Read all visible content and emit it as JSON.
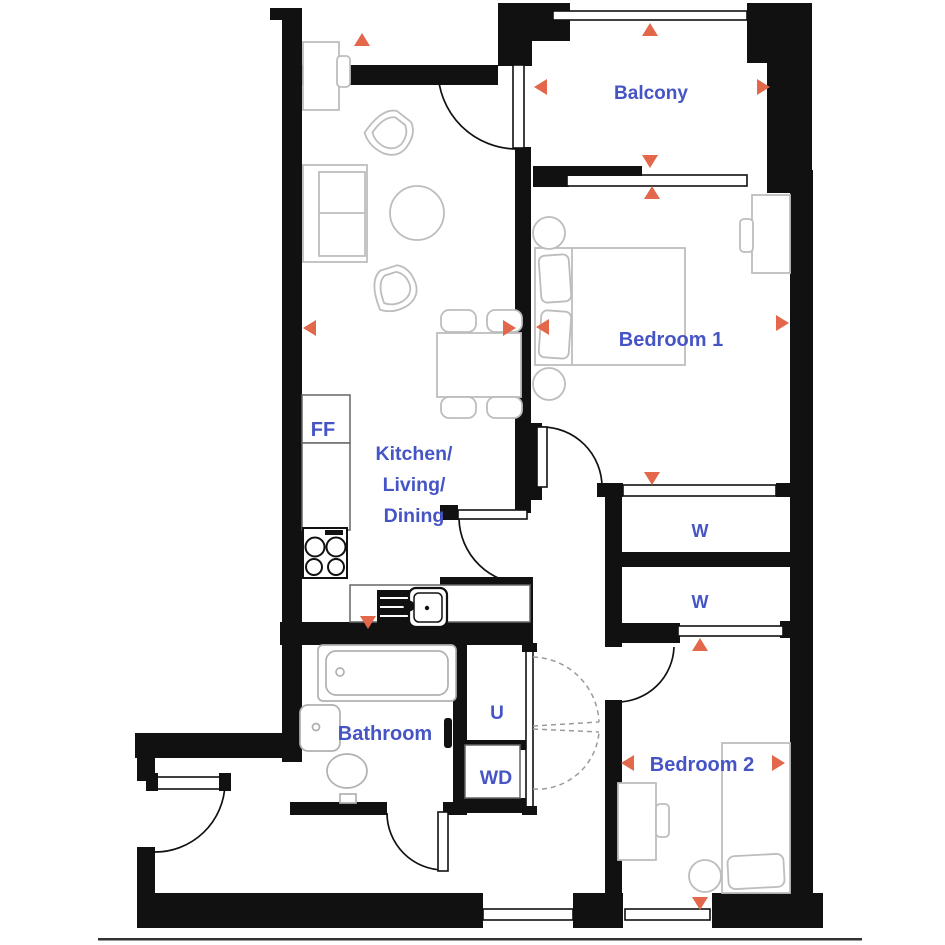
{
  "title": "apartment-floor-plan",
  "labels": {
    "balcony": "Balcony",
    "bedroom1": "Bedroom 1",
    "bedroom2": "Bedroom 2",
    "kitchen_line1": "Kitchen/",
    "kitchen_line2": "Living/",
    "kitchen_line3": "Dining",
    "bathroom": "Bathroom",
    "fridge_freezer": "FF",
    "wardrobe1": "W",
    "wardrobe2": "W",
    "utility": "U",
    "washer_dryer": "WD"
  },
  "colors": {
    "wall": "#111111",
    "label": "#4655c5",
    "arrow": "#e2674b",
    "furniture": "#bdbdbd",
    "dash": "#9a9a9a"
  },
  "arrows": [
    {
      "name": "balcony-arrow-up",
      "x": 650,
      "y": 30,
      "dir": "up"
    },
    {
      "name": "balcony-arrow-down",
      "x": 650,
      "y": 161,
      "dir": "down"
    },
    {
      "name": "balcony-arrow-left",
      "x": 541,
      "y": 87,
      "dir": "left"
    },
    {
      "name": "balcony-arrow-right",
      "x": 763,
      "y": 87,
      "dir": "right"
    },
    {
      "name": "living-arrow-up",
      "x": 362,
      "y": 40,
      "dir": "up"
    },
    {
      "name": "living-arrow-left",
      "x": 310,
      "y": 328,
      "dir": "left"
    },
    {
      "name": "living-arrow-right",
      "x": 509,
      "y": 328,
      "dir": "right"
    },
    {
      "name": "kitchen-arrow-down",
      "x": 368,
      "y": 622,
      "dir": "down"
    },
    {
      "name": "bedroom1-arrow-up",
      "x": 652,
      "y": 193,
      "dir": "up"
    },
    {
      "name": "bedroom1-arrow-down",
      "x": 652,
      "y": 478,
      "dir": "down"
    },
    {
      "name": "bedroom1-arrow-left",
      "x": 543,
      "y": 327,
      "dir": "left"
    },
    {
      "name": "bedroom1-arrow-right",
      "x": 782,
      "y": 323,
      "dir": "right"
    },
    {
      "name": "bedroom2-arrow-up",
      "x": 700,
      "y": 645,
      "dir": "up"
    },
    {
      "name": "bedroom2-arrow-down",
      "x": 700,
      "y": 903,
      "dir": "down"
    },
    {
      "name": "bedroom2-arrow-left",
      "x": 628,
      "y": 763,
      "dir": "left"
    },
    {
      "name": "bedroom2-arrow-right",
      "x": 778,
      "y": 763,
      "dir": "right"
    }
  ]
}
